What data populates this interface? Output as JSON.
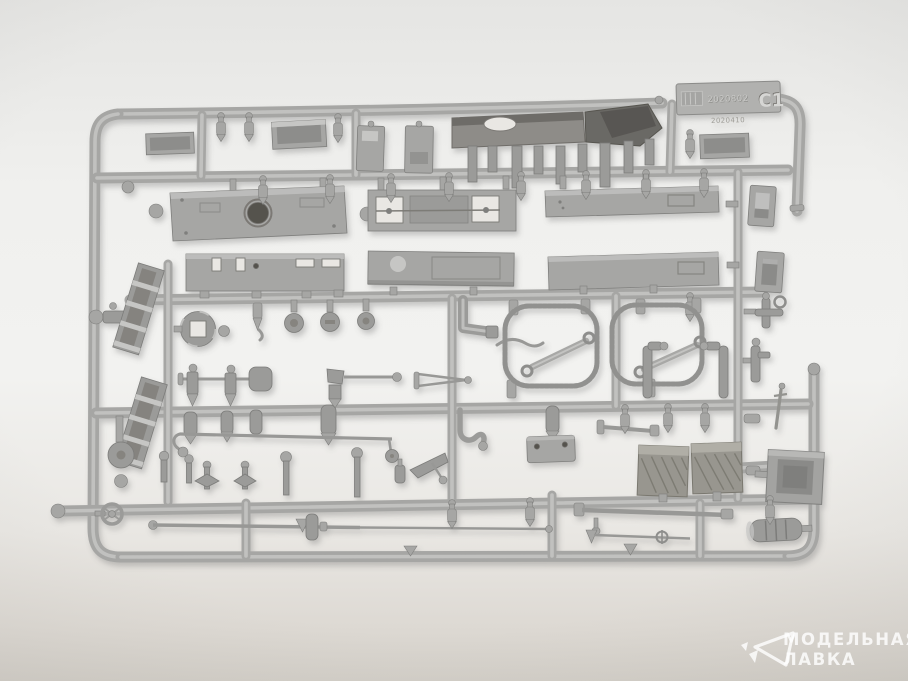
{
  "image": {
    "description": "Grey plastic injection-moulded model kit sprue (parts tree) photographed on a light studio backdrop",
    "sprue": {
      "letter": "C1",
      "embossed_code": "2020802",
      "embossed_subcode": "2020410"
    },
    "watermark": {
      "line1": "МОДЕЛЬНАЯ",
      "line2": "ЛАВКА"
    },
    "palette": {
      "plastic": "#a6a6a4",
      "plastic_light": "#c6c6c4",
      "plastic_dark": "#7f7f7d",
      "backdrop": "#f2f2f0",
      "backdrop_edge": "#d5d2cb",
      "watermark": "#ffffff"
    }
  }
}
